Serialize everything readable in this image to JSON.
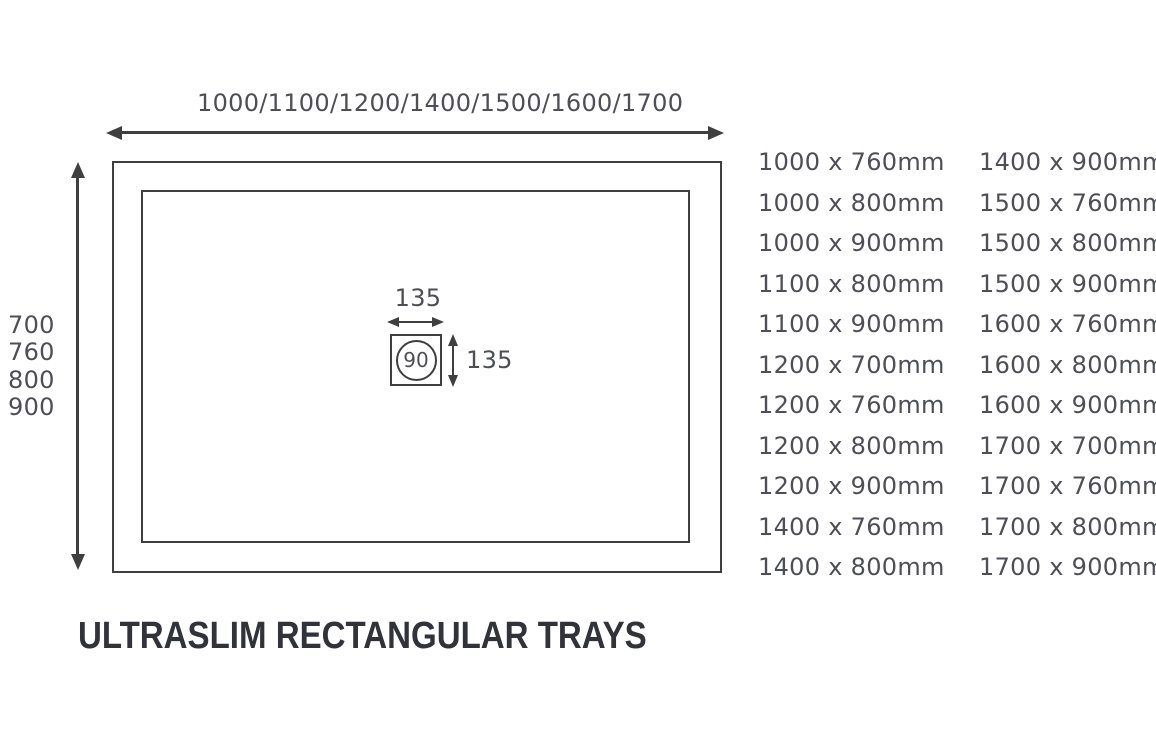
{
  "title": "ULTRASLIM RECTANGULAR TRAYS",
  "diagram": {
    "width_options": "1000/1100/1200/1400/1500/1600/1700",
    "depth_options": [
      "700",
      "760",
      "800",
      "900"
    ],
    "waste": {
      "diameter": "90",
      "width_label": "135",
      "depth_label": "135"
    }
  },
  "sizes": {
    "column1": [
      "1000 x 760mm",
      "1000 x 800mm",
      "1000 x 900mm",
      "1100 x 800mm",
      "1100 x 900mm",
      "1200 x 700mm",
      "1200 x 760mm",
      "1200 x 800mm",
      "1200 x 900mm",
      "1400 x 760mm",
      "1400 x 800mm"
    ],
    "column2": [
      "1400 x 900mm",
      "1500 x 760mm",
      "1500 x 800mm",
      "1500 x 900mm",
      "1600 x 760mm",
      "1600 x 800mm",
      "1600 x 900mm",
      "1700 x 700mm",
      "1700 x 760mm",
      "1700 x 800mm",
      "1700 x 900mm"
    ]
  },
  "colors": {
    "line": "#3f3f3f",
    "text": "#4e4e57",
    "title": "#32323a",
    "bg": "#ffffff"
  }
}
